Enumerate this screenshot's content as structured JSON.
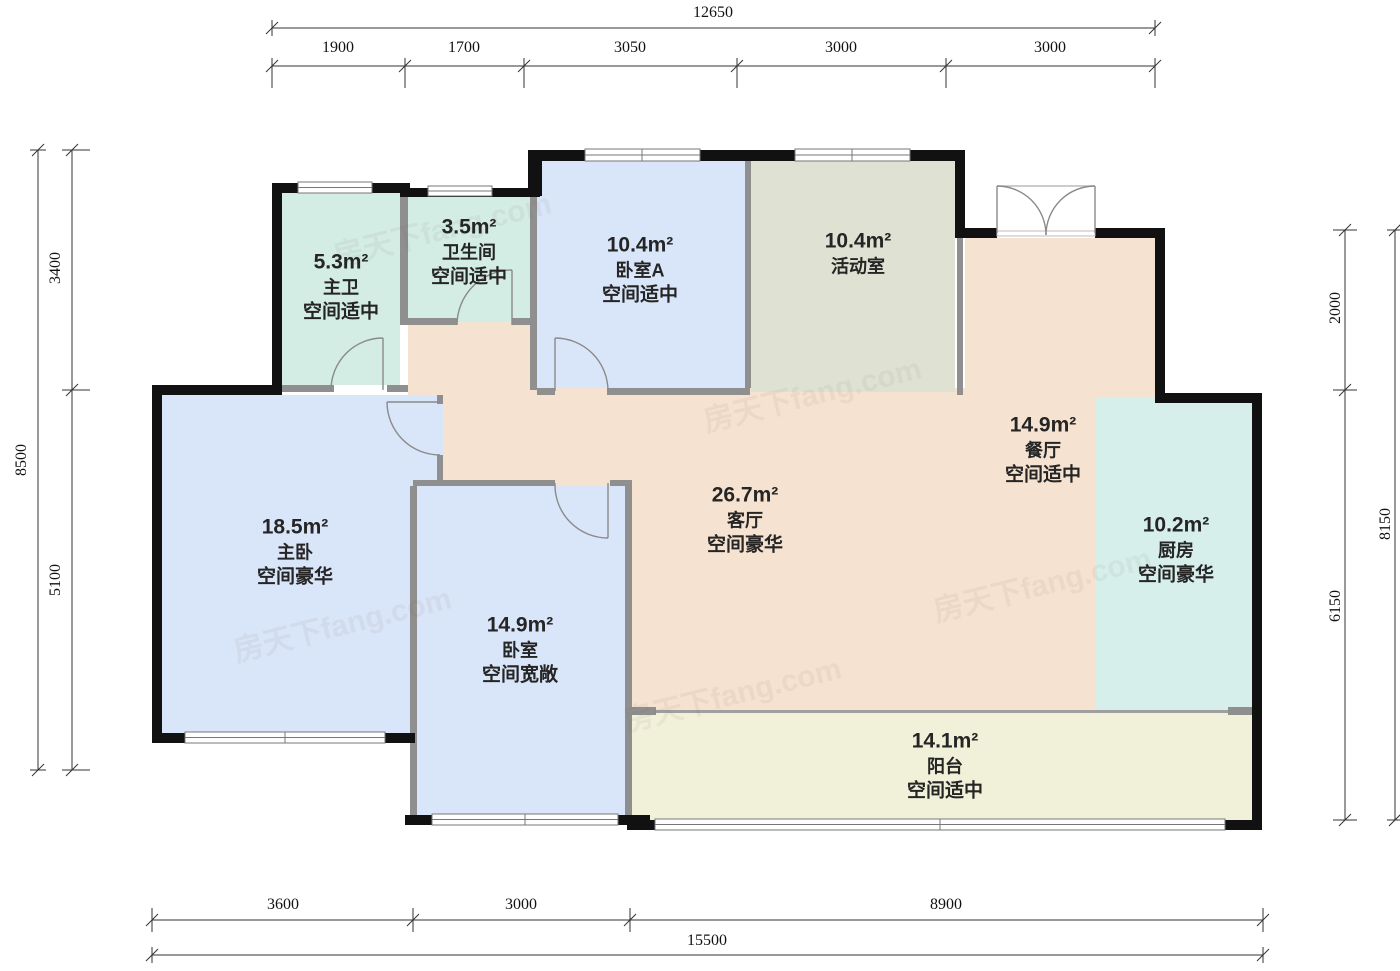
{
  "floorplan": {
    "watermark": "房天下fang.com",
    "rooms": [
      {
        "id": "master-bath",
        "area": "5.3m²",
        "name": "主卫",
        "desc": "空间适中",
        "color": "#d3ece4"
      },
      {
        "id": "bathroom",
        "area": "3.5m²",
        "name": "卫生间",
        "desc": "空间适中",
        "color": "#d3ece4"
      },
      {
        "id": "bedroom-a",
        "area": "10.4m²",
        "name": "卧室A",
        "desc": "空间适中",
        "color": "#d9e5f8"
      },
      {
        "id": "activity-room",
        "area": "10.4m²",
        "name": "活动室",
        "desc": "",
        "color": "#dfe2d3"
      },
      {
        "id": "dining-room",
        "area": "14.9m²",
        "name": "餐厅",
        "desc": "空间适中",
        "color": "#f6e2d0"
      },
      {
        "id": "living-room",
        "area": "26.7m²",
        "name": "客厅",
        "desc": "空间豪华",
        "color": "#f6e2d0"
      },
      {
        "id": "kitchen",
        "area": "10.2m²",
        "name": "厨房",
        "desc": "空间豪华",
        "color": "#d6efeb"
      },
      {
        "id": "master-bedroom",
        "area": "18.5m²",
        "name": "主卧",
        "desc": "空间豪华",
        "color": "#d9e5f8"
      },
      {
        "id": "bedroom",
        "area": "14.9m²",
        "name": "卧室",
        "desc": "空间宽敞",
        "color": "#d9e5f8"
      },
      {
        "id": "balcony",
        "area": "14.1m²",
        "name": "阳台",
        "desc": "空间适中",
        "color": "#f1f0d9"
      }
    ],
    "dimensions": {
      "top": {
        "total": "12650",
        "segments": [
          "1900",
          "1700",
          "3050",
          "3000",
          "3000"
        ]
      },
      "left": {
        "total": "8500",
        "segments": [
          "3400",
          "5100"
        ]
      },
      "right": {
        "total": "8150",
        "segments": [
          "2000",
          "6150"
        ]
      },
      "bottom": {
        "total": "15500",
        "segments": [
          "3600",
          "3000",
          "8900"
        ]
      }
    },
    "colors": {
      "wall": "#111111",
      "thin_wall": "#8f8f8f",
      "dim_line": "#333333",
      "mint": "#d3ece4",
      "blue": "#d9e5f8",
      "gray_green": "#dfe2d3",
      "peach": "#f6e2d0",
      "teal": "#d6efeb",
      "cream": "#f1f0d9"
    }
  }
}
